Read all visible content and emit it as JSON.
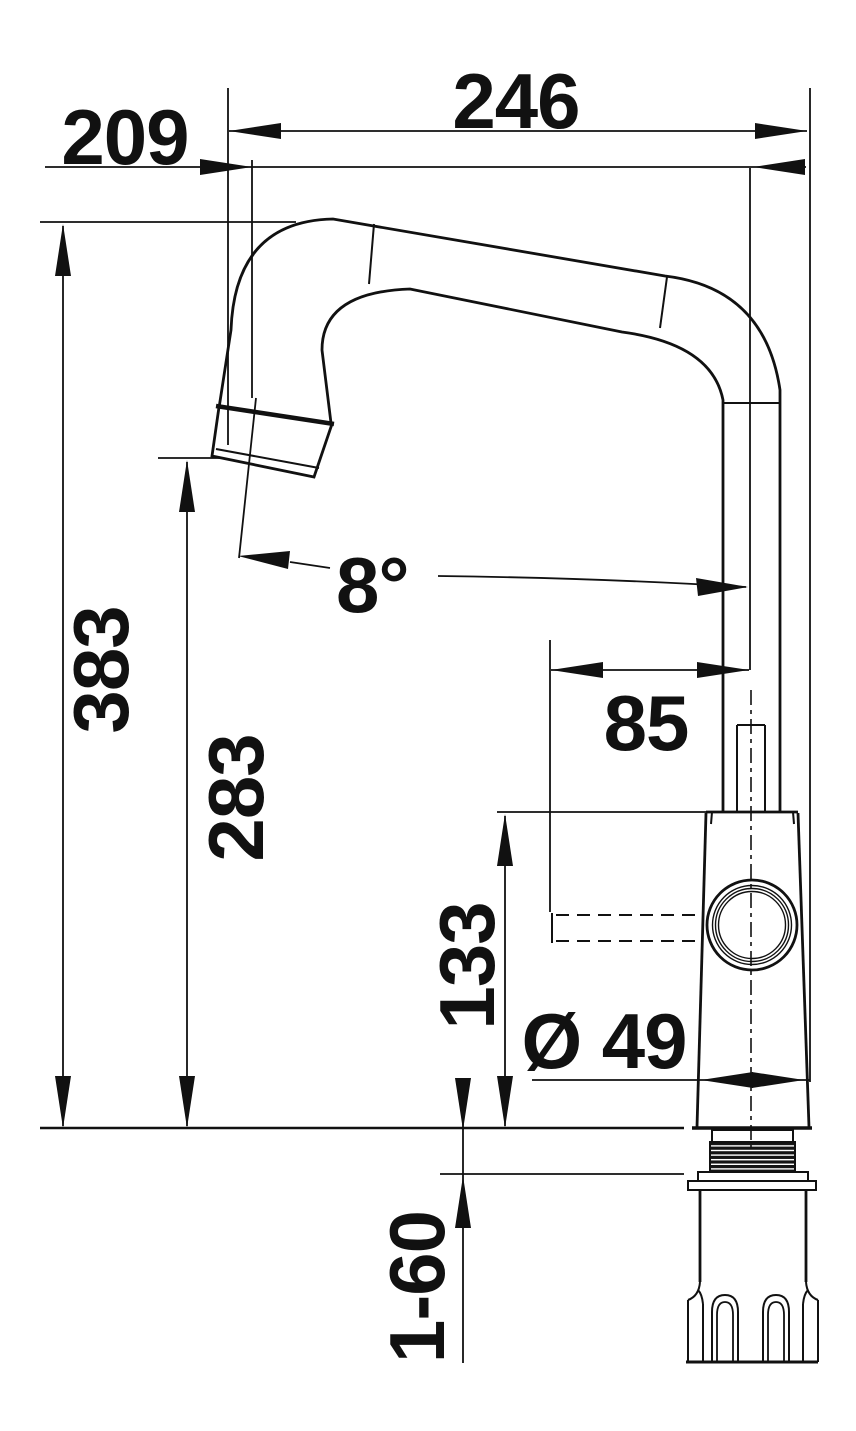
{
  "drawing": {
    "type": "technical dimension drawing",
    "subject": "kitchen mixer tap, side elevation with pull-out spout",
    "background_color": "#ffffff",
    "line_color": "#111111",
    "labels": {
      "dim_reach": "246",
      "dim_reach_outlet": "209",
      "dim_height_total": "383",
      "dim_height_outlet": "283",
      "dim_angle": "8°",
      "dim_lever": "85",
      "dim_body_height": "133",
      "dim_base_diameter": "Ø 49",
      "dim_mounting_range": "1-60"
    }
  }
}
